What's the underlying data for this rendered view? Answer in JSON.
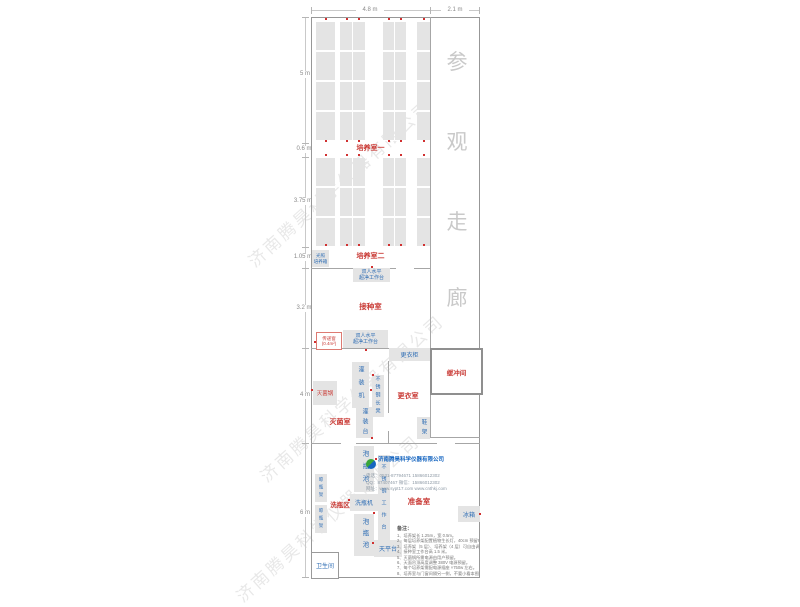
{
  "dims": {
    "top": [
      "4.8 m",
      "2.1 m"
    ],
    "left": [
      "5 m",
      "0.6 m",
      "3.75 m",
      "1.05 m",
      "3.2 m",
      "4 m",
      "6 m"
    ]
  },
  "rooms": {
    "culture1": "培养室一",
    "culture2": "培养室二",
    "inoculation": "接种室",
    "sterilize": "灭菌室",
    "changing": "更衣室",
    "buffer": "缓冲间",
    "washing": "洗瓶区",
    "prep": "准备室",
    "toilet": "卫生间"
  },
  "corridor_chars": [
    "参",
    "观",
    "走",
    "廊"
  ],
  "equipment": {
    "light_incubator": {
      "line1": "光照",
      "line2": "培养箱"
    },
    "clean_bench_1": {
      "line1": "双人水平",
      "line2": "超净工作台"
    },
    "clean_bench_2": {
      "line1": "双人水平",
      "line2": "超净工作台"
    },
    "pass_window": {
      "line1": "传递窗",
      "line2": "(0.4m²)"
    },
    "wardrobe": "更衣柜",
    "autoclave": "灭菌锅",
    "filling_machine": "灌装机",
    "steel_bench": "不锈钢长凳",
    "filling_table": "灌装台",
    "shoe_rack": "鞋架",
    "soak_pool_1": "泡瓶池",
    "soak_pool_2": "泡瓶池",
    "bottle_washer": "洗瓶机",
    "steel_worktable": "不锈钢工作台",
    "drying_rack_1": "晾瓶架",
    "drying_rack_2": "晾瓶架",
    "balance_table": "天平台",
    "fridge": "冰箱"
  },
  "company": {
    "name": "济南腾昊科学仪器有限公司",
    "lines": [
      "电话：0531-87794671  15866012302",
      "QQ：87407467  微信：15866012302",
      "网址：www.sypt17.com  www.cnthkj.com"
    ]
  },
  "notes": {
    "title": "备注：",
    "items": [
      "1、培养架长 1.25m，宽 0.5m。",
      "2、每层培养架配置植物生长灯，40cm 预留电源插座。",
      "3、培养架（5 层）、培养架（4 层）可自由调整。",
      "4、接种室工作台高 1.5 米。",
      "5、灭菌锅所需电源由用户预留。",
      "6、天面吊顶高度调整 380V 电源预留。",
      "7、每个培养架需配电源插座 ×750w 左右。",
      "8、培养室与门窗间隔另一侧，不要小看本图纸。"
    ]
  },
  "watermark": "济南腾昊科学仪器有限公司",
  "colors": {
    "room_label": "#c93a35",
    "equipment_label": "#2e6db4",
    "rack_fill": "#e4e4e4"
  }
}
